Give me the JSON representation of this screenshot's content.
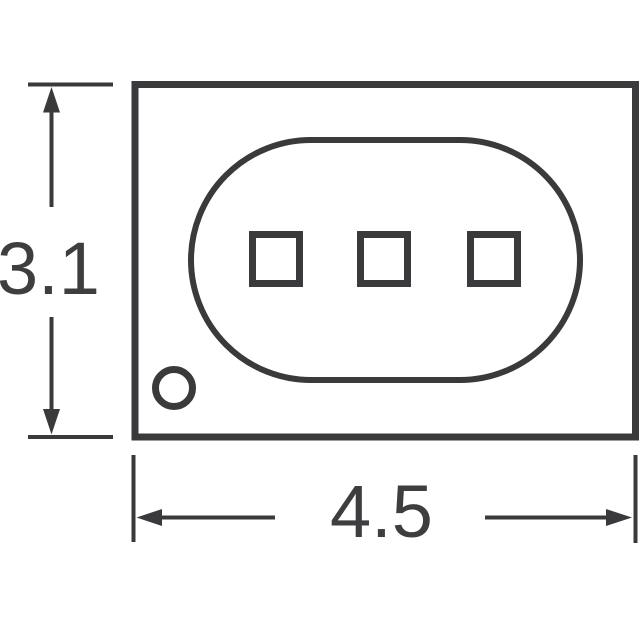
{
  "drawing": {
    "kind": "package-outline-technical-drawing",
    "dimensions": {
      "height": {
        "label": "3.1"
      },
      "width": {
        "label": "4.5"
      }
    },
    "colors": {
      "stroke": "#3a3a3c",
      "text": "#3e3e40",
      "background": "#ffffff"
    },
    "shapes": {
      "package_body": "rectangle",
      "emitter_window": "stadium",
      "chip_pad_count": 3,
      "polarity_marker": "circle"
    }
  }
}
